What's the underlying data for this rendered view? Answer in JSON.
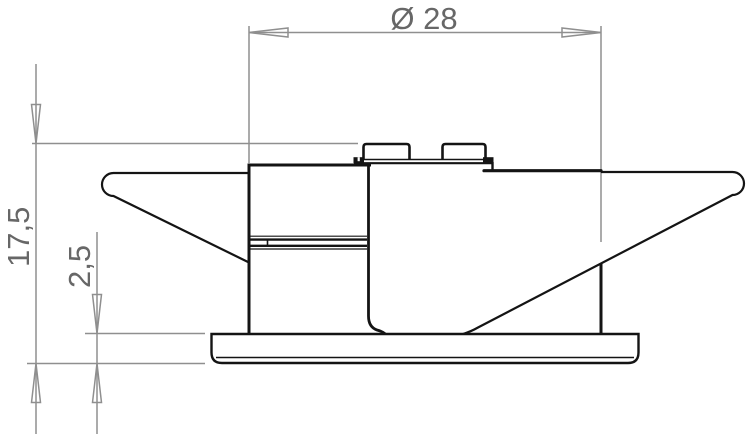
{
  "drawing": {
    "title": "part-side-view-technical-drawing",
    "background": "#ffffff",
    "colors": {
      "outline": "#141414",
      "dimension": "#8f8f8f",
      "label": "#676767"
    },
    "dimensions": {
      "diameter": {
        "label": "Ø 28",
        "value": "28"
      },
      "overall_height": {
        "label": "17,5",
        "value": "17,5"
      },
      "flange_thickness": {
        "label": "2,5",
        "value": "2,5"
      }
    }
  }
}
